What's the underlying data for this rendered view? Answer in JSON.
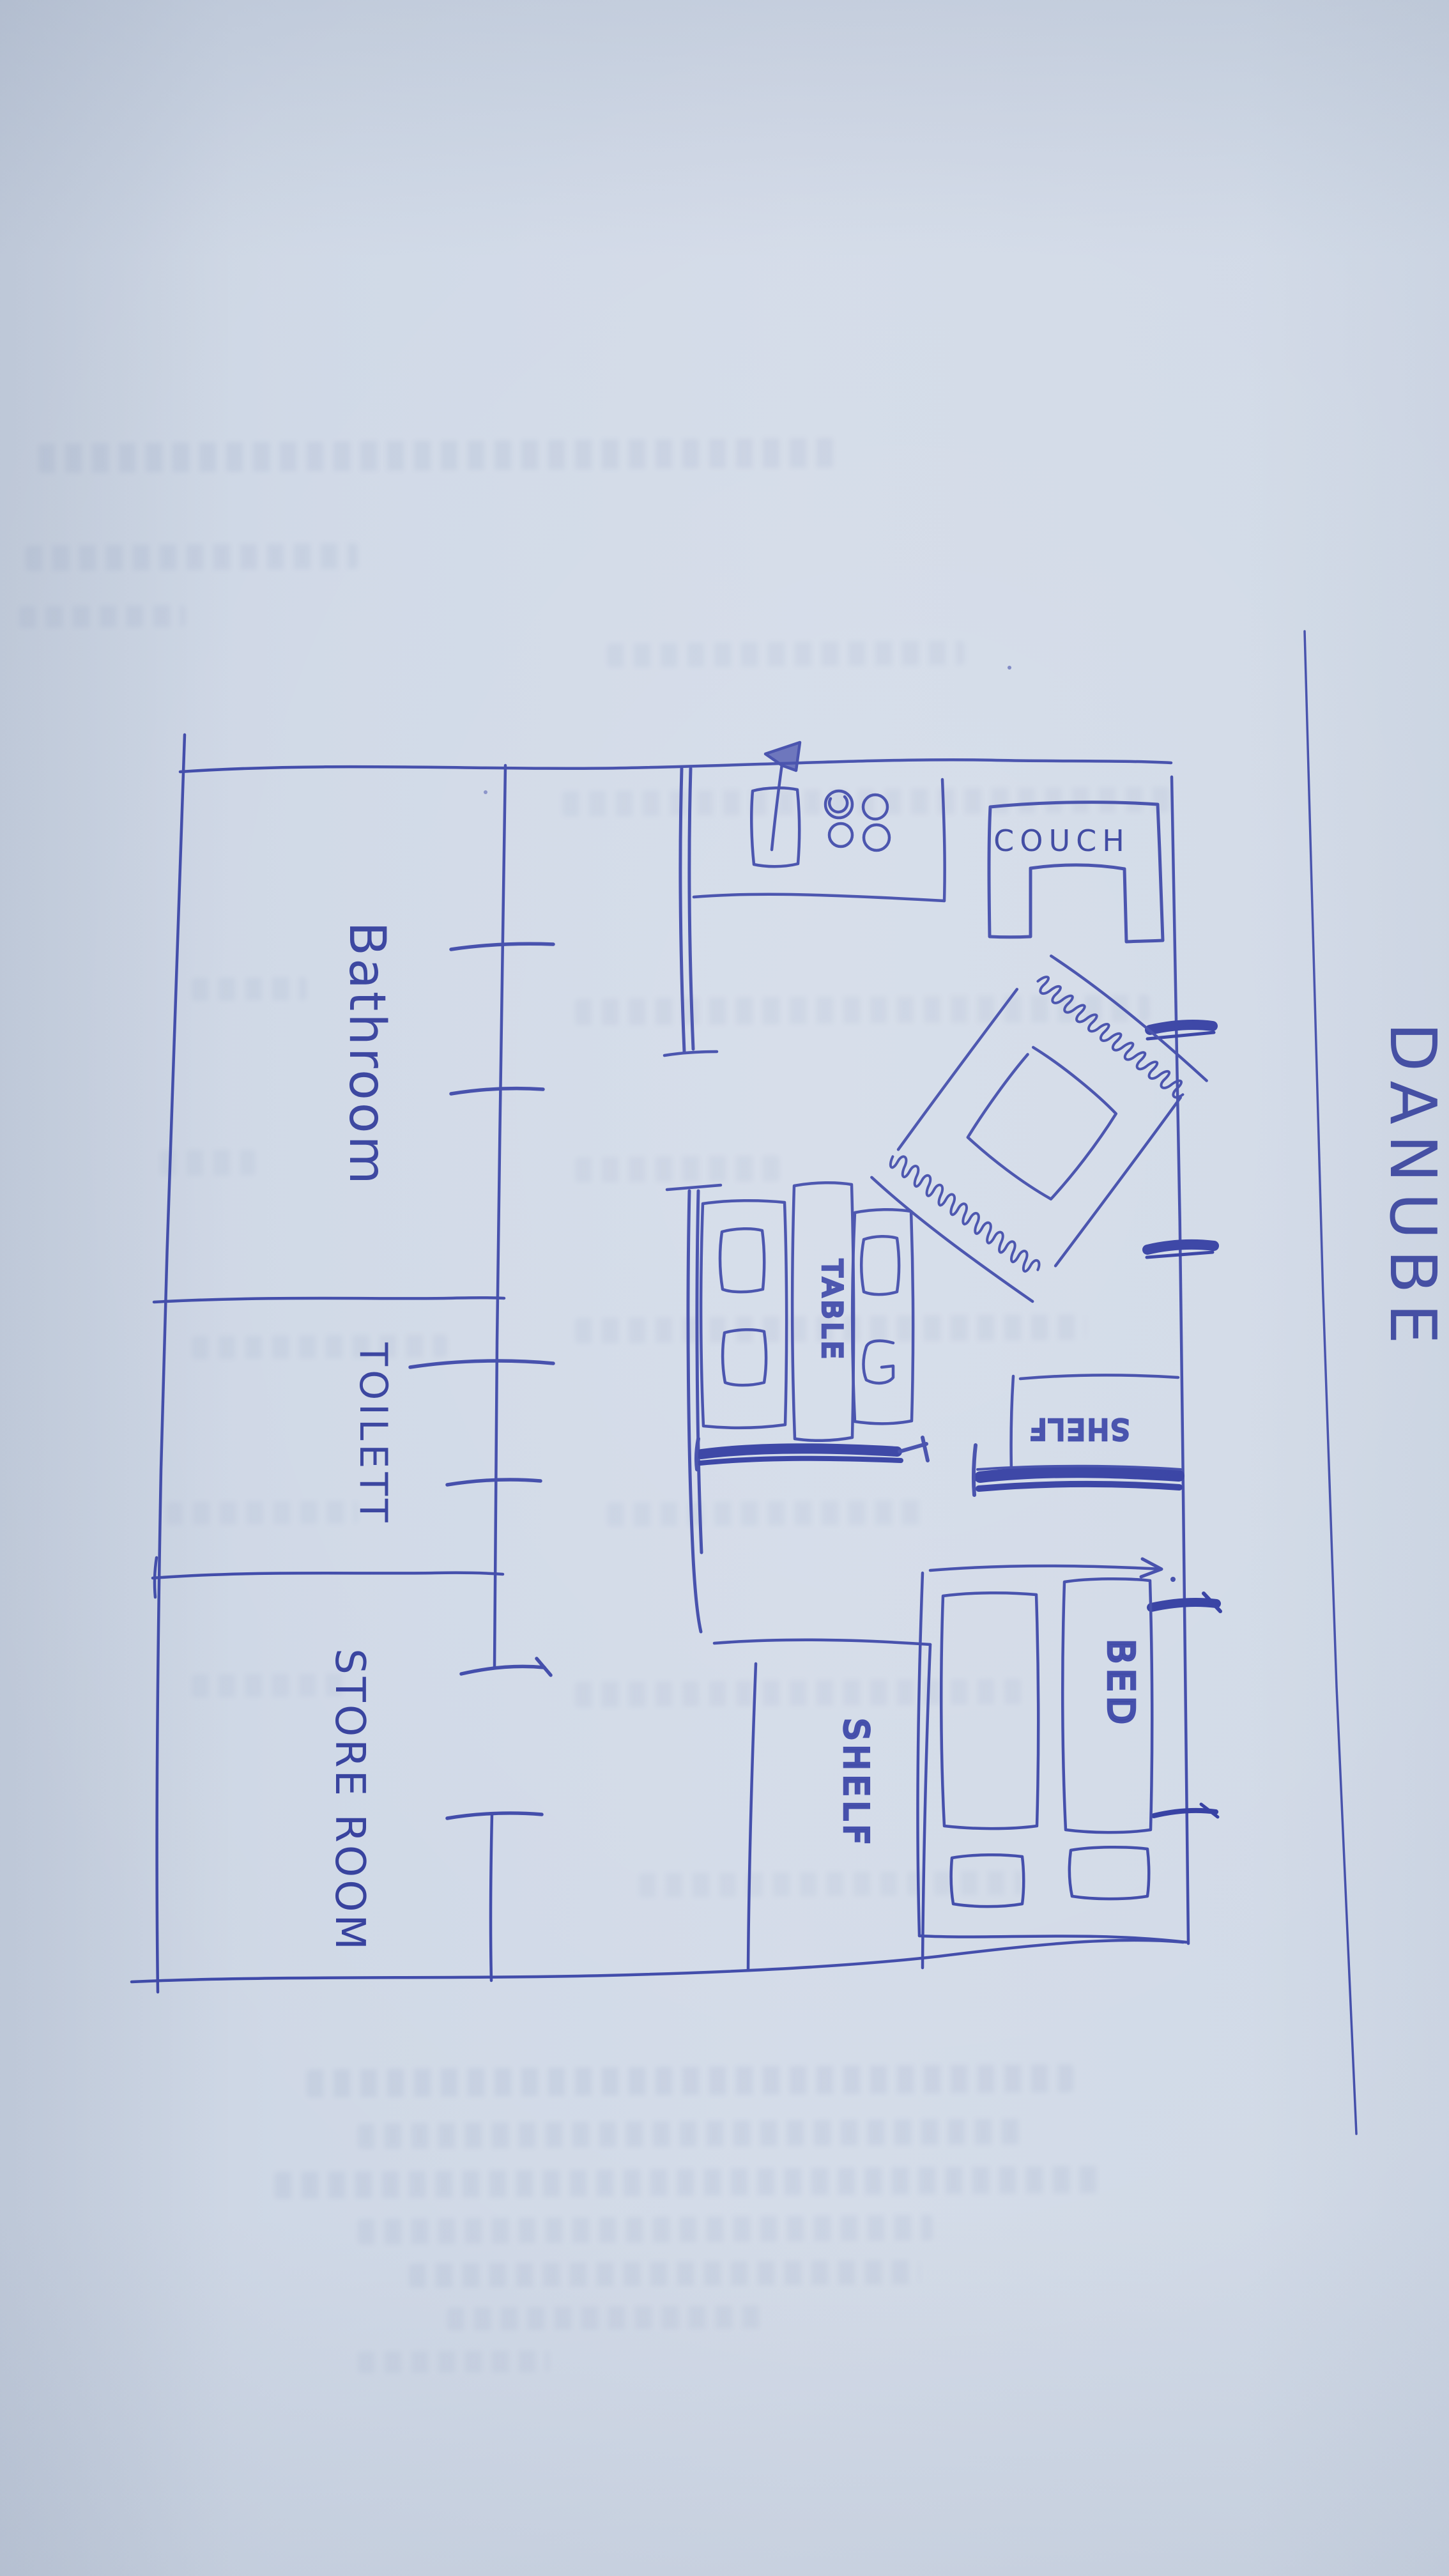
{
  "photo": {
    "description": "hand-drawn apartment floor plan sketched in blue ballpoint pen on paper",
    "pen_color": "#3c47a8",
    "pen_color_heavy": "#2f3aa0",
    "paper_color": "#cfd8e6"
  },
  "plan": {
    "rooms": [
      {
        "name": "bathroom",
        "label": "Bathroom"
      },
      {
        "name": "toilet",
        "label": "TOILETT"
      },
      {
        "name": "store-room",
        "label": "STORE ROOM"
      }
    ],
    "furniture": [
      {
        "name": "couch",
        "label": "COUCH"
      },
      {
        "name": "table",
        "label": "TABLE"
      },
      {
        "name": "bed",
        "label": "BED"
      },
      {
        "name": "shelf-bottom",
        "label": "SHELF"
      },
      {
        "name": "shelf-right",
        "label": "SHELF"
      }
    ],
    "annotations": [
      {
        "name": "river-side",
        "label": "DANUBE"
      }
    ]
  }
}
